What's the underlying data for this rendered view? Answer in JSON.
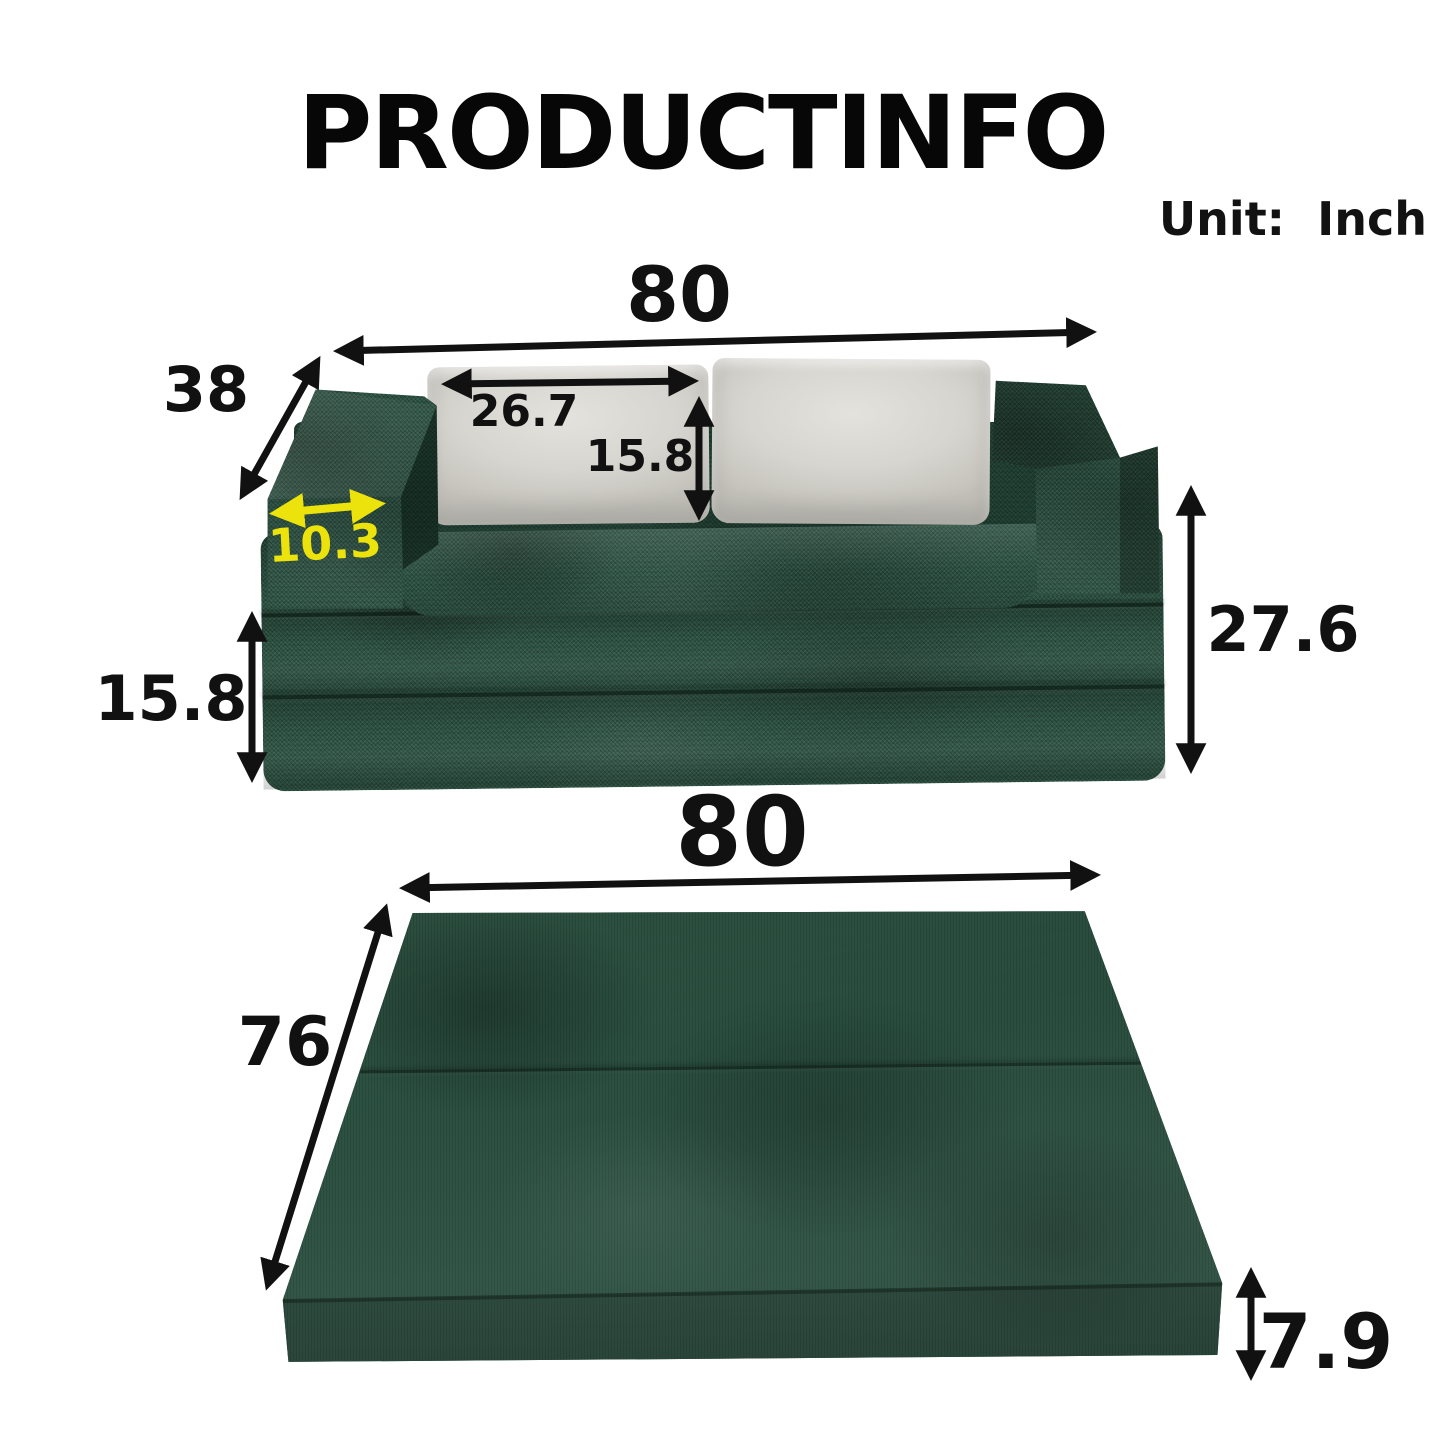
{
  "title": "PRODUCTINFO",
  "unit": {
    "label": "Unit:  Inch"
  },
  "sofa_view": {
    "width": "80",
    "depth": "38",
    "pillow_width": "26.7",
    "pillow_height": "15.8",
    "armrest_width": "10.3",
    "base_height": "15.8",
    "total_height": "27.6"
  },
  "mattress_view": {
    "width": "80",
    "depth": "76",
    "thickness": "7.9"
  },
  "colors": {
    "background": "#ffffff",
    "fabric_green": "#2d5444",
    "fabric_dark": "#16301f",
    "pillow_gray": "#d7d5cf",
    "dimension_black": "#111111",
    "dimension_yellow": "#ece20c"
  }
}
